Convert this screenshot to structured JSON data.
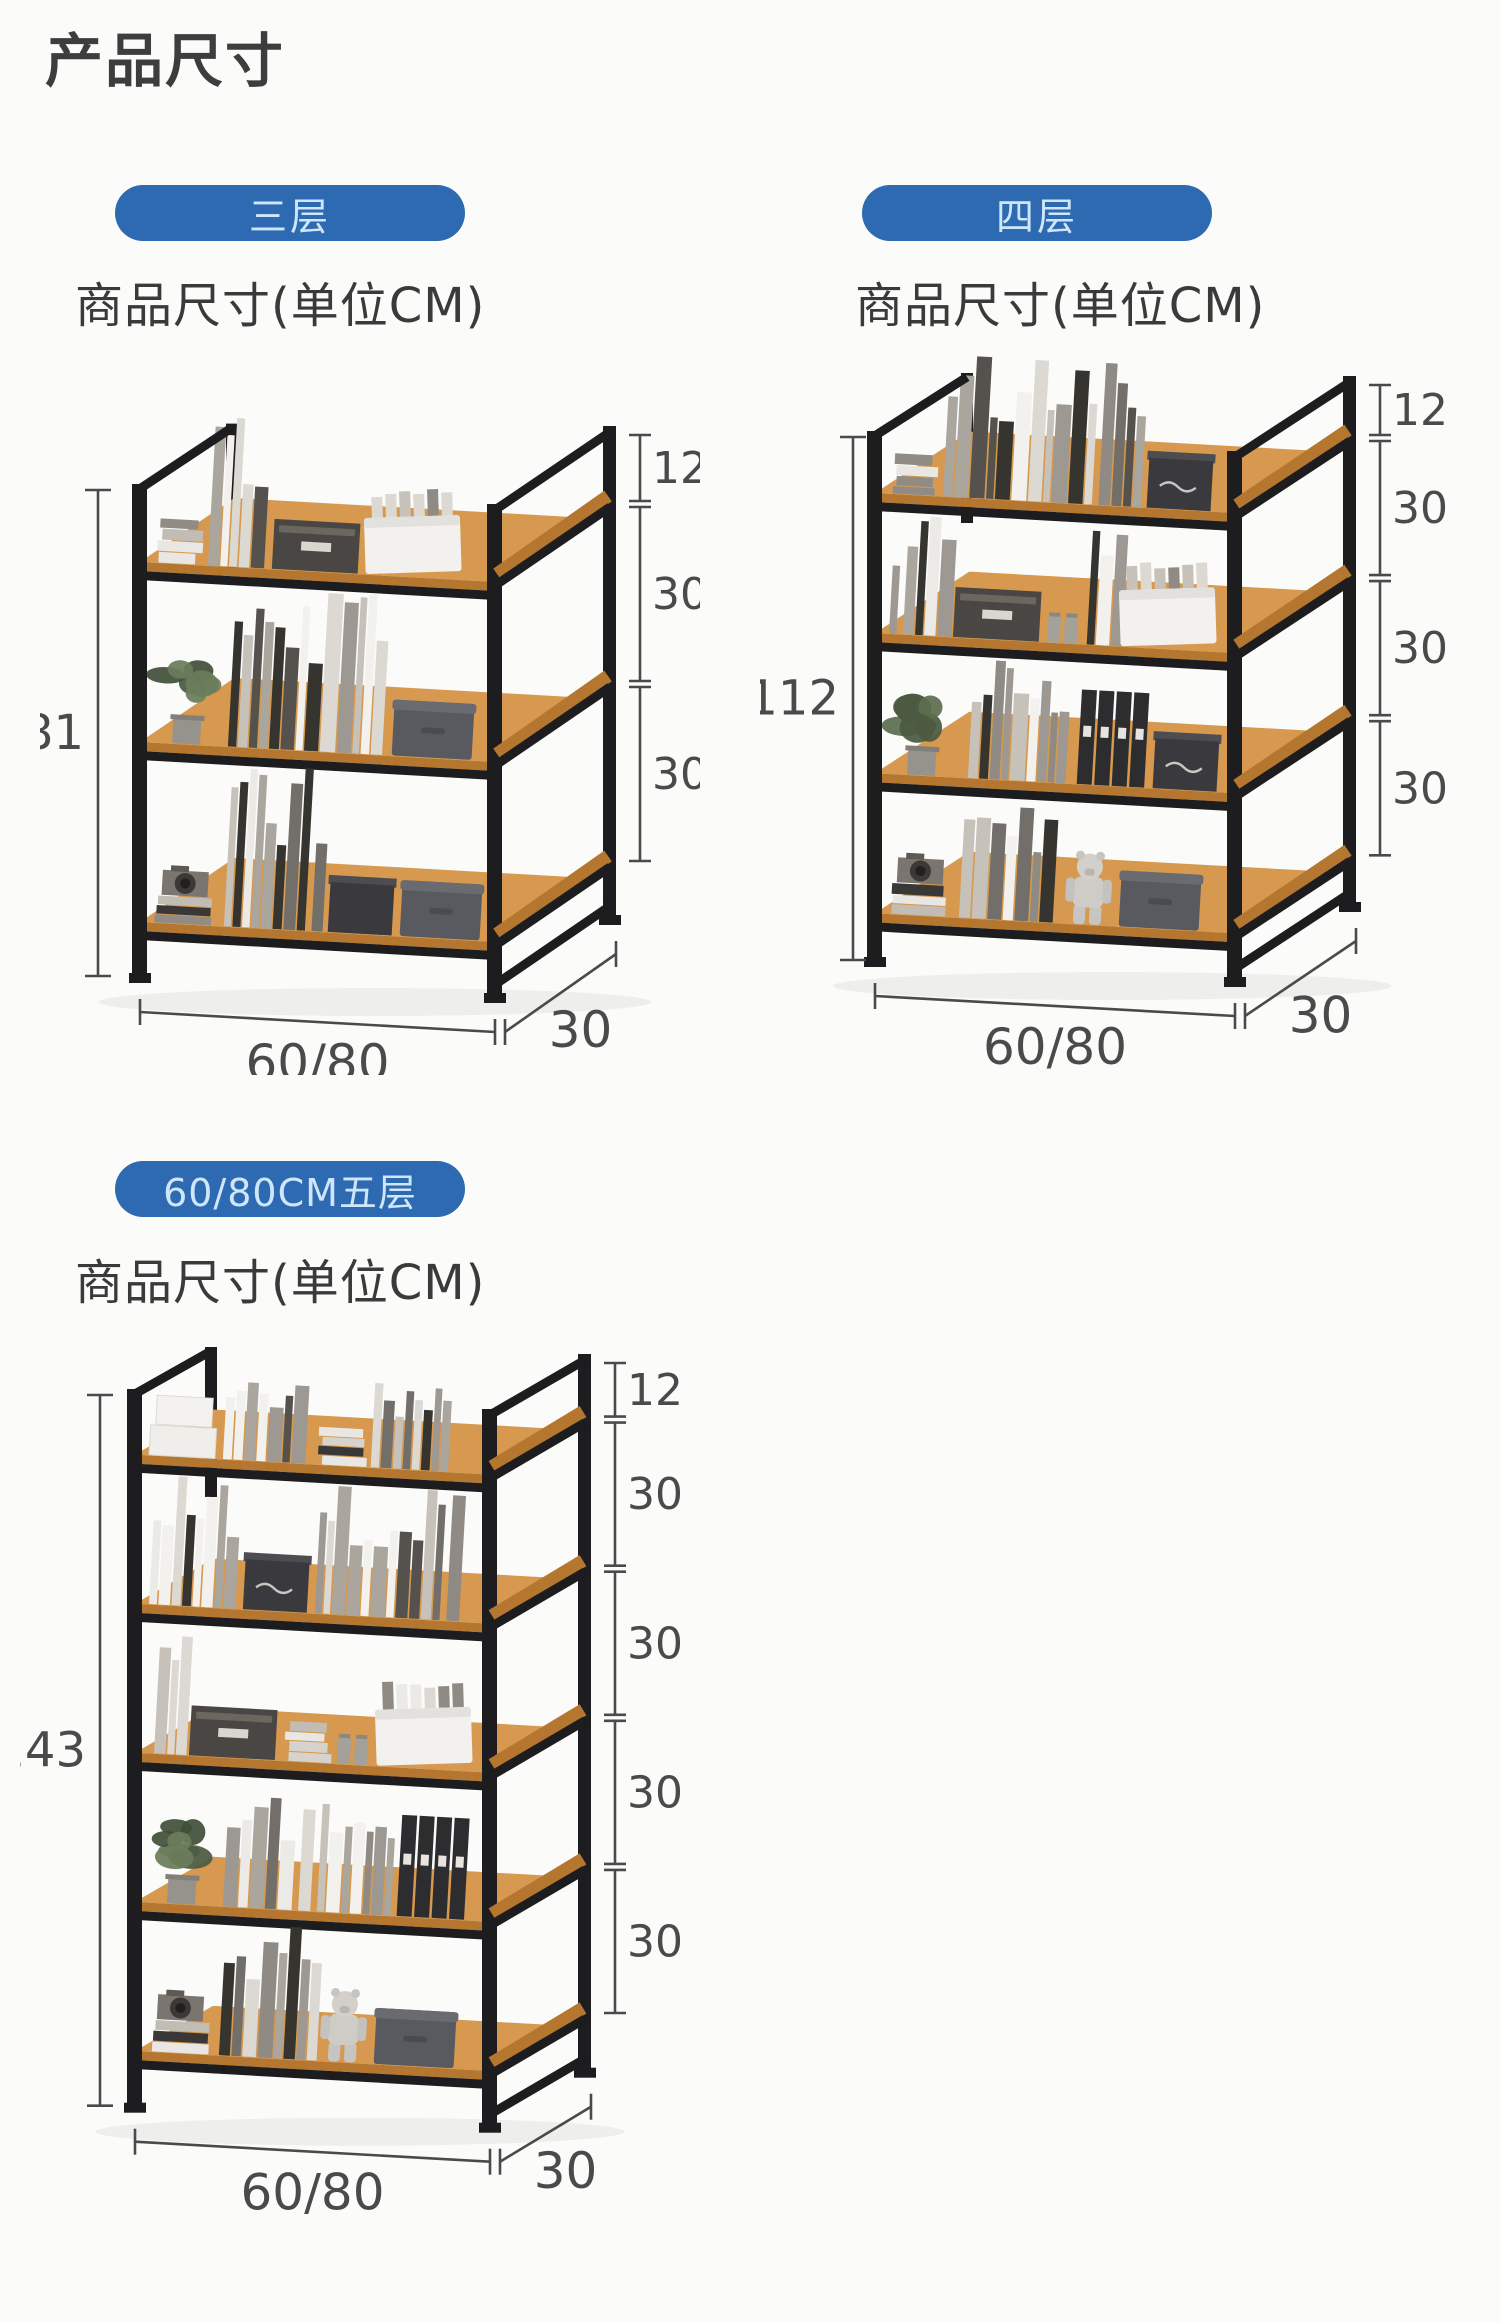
{
  "page": {
    "title": "产品尺寸"
  },
  "sections": [
    {
      "badge": "三层",
      "heading": "商品尺寸(单位CM)",
      "tiers": 3,
      "height_label": "81",
      "right_labels": [
        "12",
        "30",
        "30"
      ],
      "width_label": "60/80",
      "depth_label": "30"
    },
    {
      "badge": "四层",
      "heading": "商品尺寸(单位CM)",
      "tiers": 4,
      "height_label": "112",
      "right_labels": [
        "12",
        "30",
        "30",
        "30"
      ],
      "width_label": "60/80",
      "depth_label": "30"
    },
    {
      "badge": "60/80CM五层",
      "heading": "商品尺寸(单位CM)",
      "tiers": 5,
      "height_label": "143",
      "right_labels": [
        "12",
        "30",
        "30",
        "30",
        "30"
      ],
      "width_label": "60/80",
      "depth_label": "30"
    }
  ],
  "colors": {
    "badge_bg": "#2e6ab2",
    "badge_text": "#cfe6fa",
    "frame": "#1d1d20",
    "wood": "#b5762f",
    "wood_top": "#d6994f",
    "dimension": "#4a4a4a",
    "title_text": "#3d3d3d"
  }
}
